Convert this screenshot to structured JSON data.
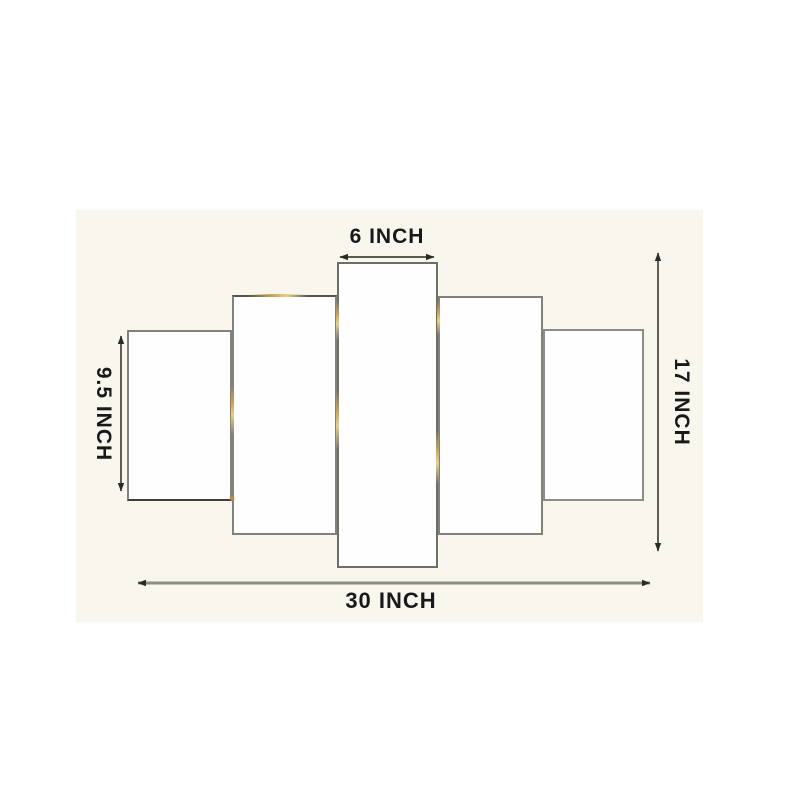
{
  "diagram": {
    "kind": "product dimension diagram",
    "subject": "5-panel canvas wall art set",
    "panel_count": 5,
    "panels": [
      {
        "id": "panel-1",
        "position": "far-left"
      },
      {
        "id": "panel-2",
        "position": "left"
      },
      {
        "id": "panel-3",
        "position": "center"
      },
      {
        "id": "panel-4",
        "position": "right"
      },
      {
        "id": "panel-5",
        "position": "far-right"
      }
    ],
    "dimensions": {
      "top": {
        "label": "6 INCH"
      },
      "left": {
        "label": "9.5 INCH"
      },
      "right": {
        "label": "17 INCH"
      },
      "bottom": {
        "label": "30 INCH"
      }
    },
    "colors": {
      "page_background": "#ffffff",
      "photo_background": "#f8f6ed",
      "panel_fill": "#fefefe",
      "panel_border": "#82817b",
      "dimension_line": "#45443f",
      "bottom_dimension_line": "#8e8d85",
      "label_text": "#191919",
      "gold_edge_glint": "#c8a254",
      "orange_edge_glint": "#d98a3f"
    }
  }
}
